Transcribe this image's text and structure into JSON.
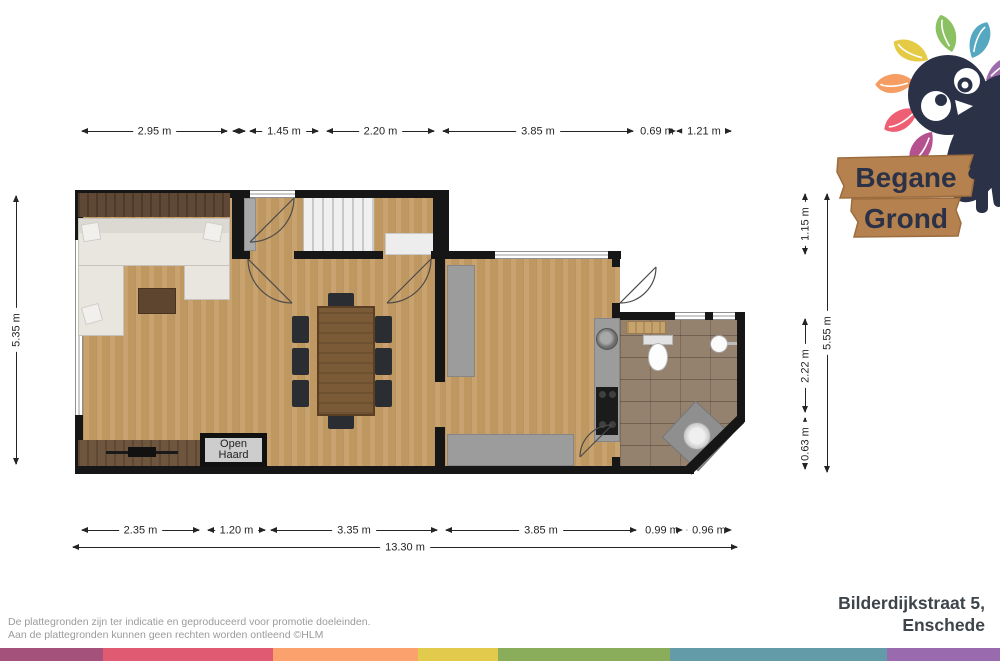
{
  "header": {
    "title_line1": "Begane",
    "title_line2": "Grond"
  },
  "plan": {
    "open_haard_label": "Open Haard"
  },
  "dimensions": {
    "top": [
      "2.95 m",
      "1.45 m",
      "2.20 m",
      "3.85 m",
      "0.69 m",
      "1.21 m"
    ],
    "bottom": [
      "2.35 m",
      "1.20 m",
      "3.35 m",
      "3.85 m",
      "0.99 m",
      "0.96 m"
    ],
    "bottom_total": "13.30 m",
    "left": "5.35 m",
    "right": [
      "1.15 m",
      "2.22 m",
      "0.63 m"
    ],
    "right_total": "5.55 m"
  },
  "footer": {
    "disclaimer_line1": "De plattegronden zijn ter indicatie en geproduceerd voor promotie doeleinden.",
    "disclaimer_line2": "Aan de plattegronden kunnen geen rechten worden ontleend ©HLM",
    "address_line1": "Bilderdijkstraat 5,",
    "address_line2": "Enschede"
  },
  "colors": {
    "wall": "#161616",
    "wood_floor": "#c59d66",
    "tile_floor": "#95826e",
    "accent_navy": "#2b3147",
    "sign_wood": "#b5814e",
    "leaves": [
      "#f59d62",
      "#e5cb45",
      "#8bc063",
      "#56a7c0",
      "#9b6bab",
      "#ee5f74",
      "#b5518f"
    ],
    "stripe": [
      "#a4527c",
      "#e05a72",
      "#fba16e",
      "#e2ca4d",
      "#8aad5b",
      "#639ba9",
      "#9a6aae"
    ]
  }
}
